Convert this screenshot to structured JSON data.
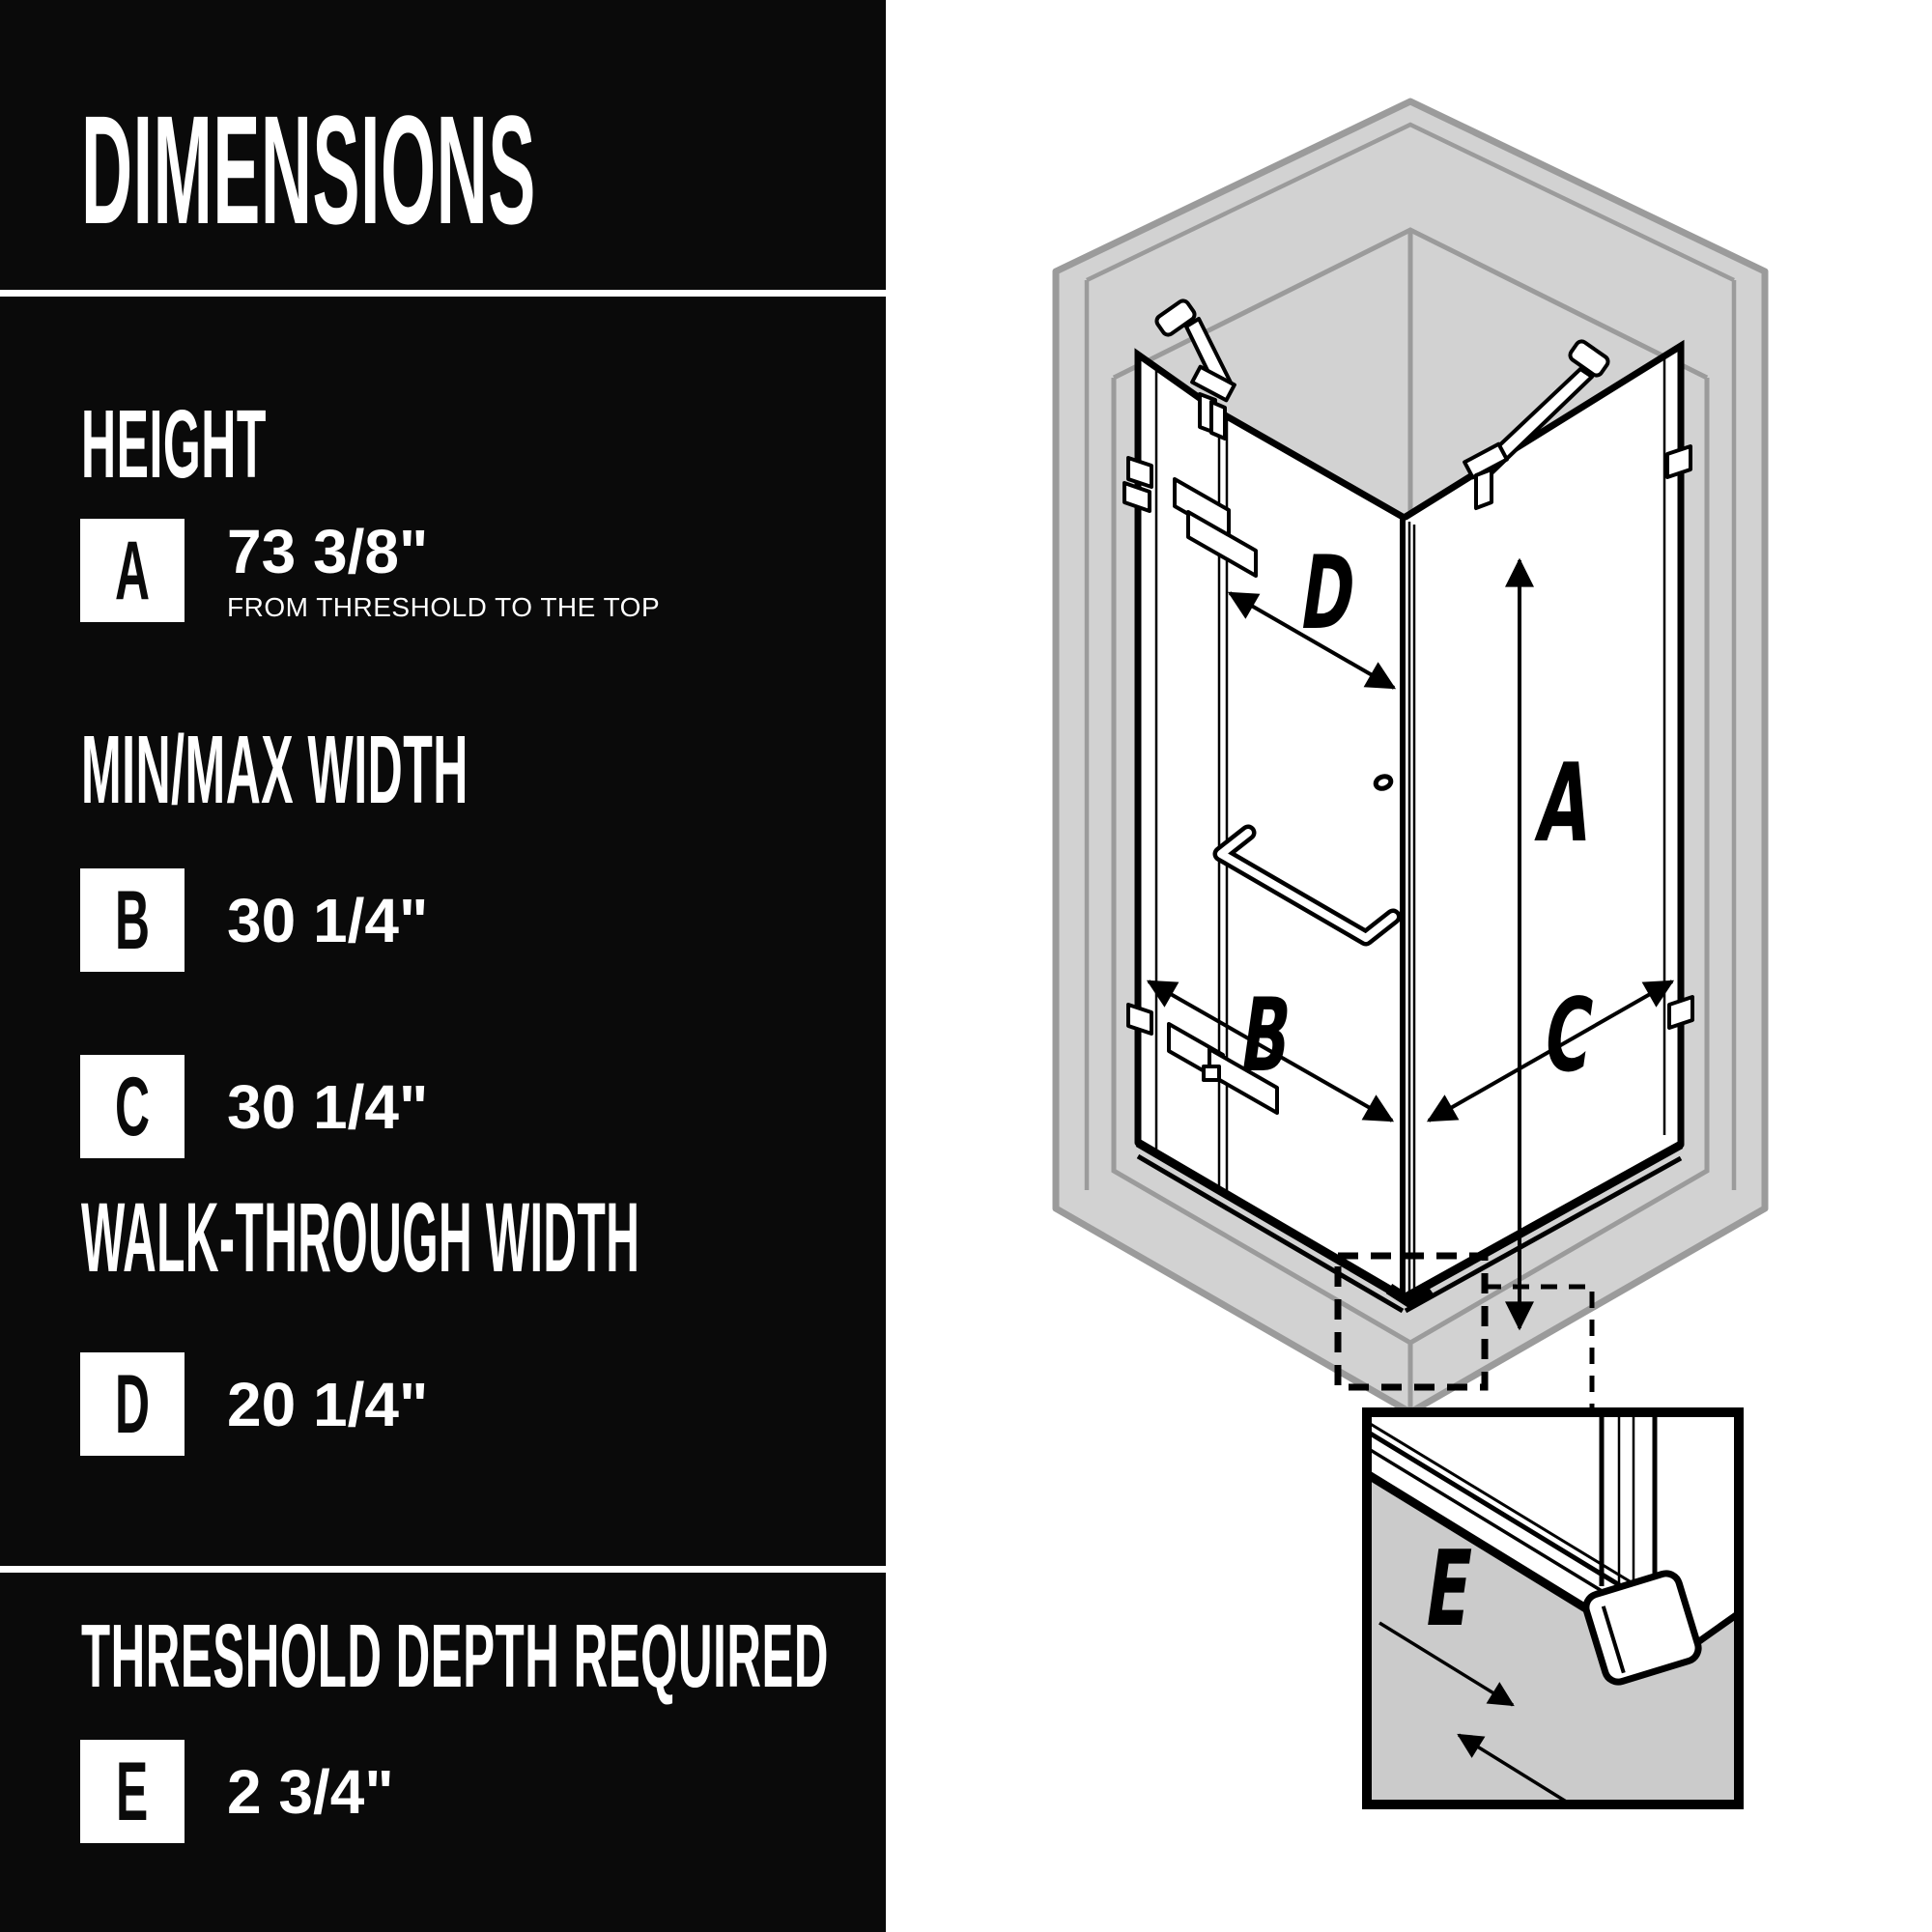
{
  "panel": {
    "title": "DIMENSIONS",
    "sections": [
      {
        "heading": "HEIGHT",
        "rows": [
          {
            "badge": "A",
            "value": "73 3/8\"",
            "note": "FROM THRESHOLD TO THE TOP"
          }
        ]
      },
      {
        "heading": "MIN/MAX WIDTH",
        "rows": [
          {
            "badge": "B",
            "value": "30 1/4\""
          },
          {
            "badge": "C",
            "value": "30 1/4\""
          }
        ]
      },
      {
        "heading": "WALK-THROUGH WIDTH",
        "rows": [
          {
            "badge": "D",
            "value": "20 1/4\""
          }
        ]
      },
      {
        "heading": "THRESHOLD DEPTH REQUIRED",
        "rows": [
          {
            "badge": "E",
            "value": "2 3/4\""
          }
        ]
      }
    ]
  },
  "diagram": {
    "labels": {
      "a": "A",
      "b": "B",
      "c": "C",
      "d": "D",
      "e": "E"
    }
  },
  "colors": {
    "panel_bg": "#0a0a0a",
    "wall_fill": "#d2d2d2",
    "wall_line": "#9b9b9b",
    "ink": "#000000",
    "inset_floor": "#cbcbcb"
  }
}
